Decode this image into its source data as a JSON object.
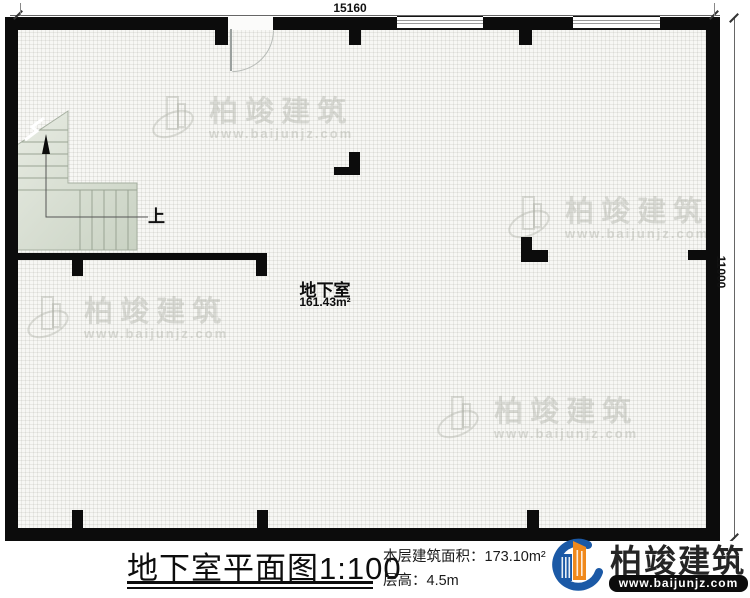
{
  "plan": {
    "dimension_top": "15160",
    "dimension_right": "11000",
    "room_name": "地下室",
    "room_area": "161.43m²",
    "stairs_up_label": "上"
  },
  "title_block": {
    "title": "地下室平面图",
    "scale": "1:100",
    "area_label": "本层建筑面积：",
    "area_value": "173.10m²",
    "floor_height_label": "层高：",
    "floor_height_value": "4.5m"
  },
  "brand": {
    "name": "柏竣建筑",
    "url": "www.baijunjz.com"
  },
  "watermark": {
    "name": "柏竣建筑",
    "url": "www.baijunjz.com"
  },
  "colors": {
    "wall": "#0c0c0c",
    "brand_blue": "#1b59a6",
    "brand_orange": "#f0891c"
  }
}
